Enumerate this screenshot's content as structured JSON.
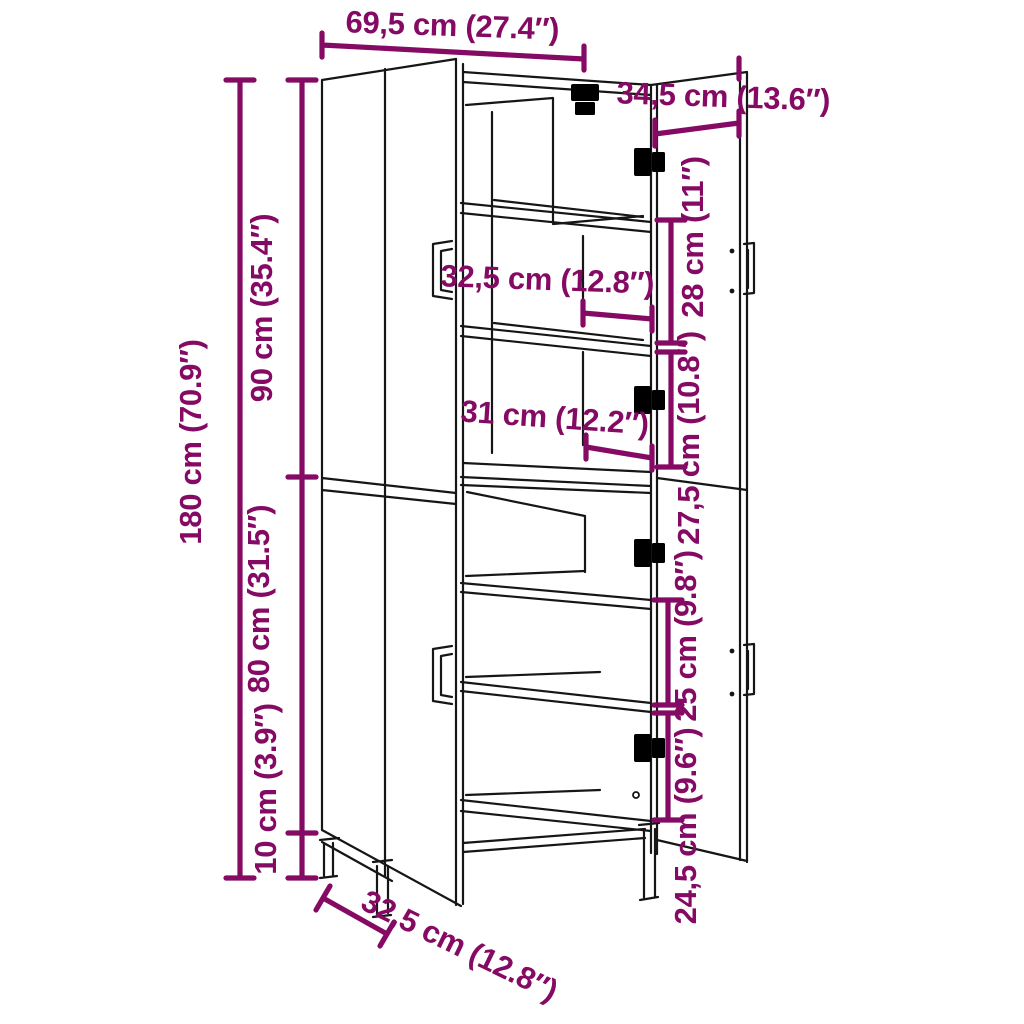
{
  "diagram": {
    "name": "tall-cabinet-dimension-diagram",
    "colors": {
      "accent": "#850a64",
      "line": "#161616",
      "background": "#ffffff"
    },
    "labels": {
      "overall_width": {
        "text": "69,5 cm (27.4″)"
      },
      "door_width": {
        "text": "34,5 cm (13.6″)"
      },
      "overall_height": {
        "text": "180 cm (70.9″)"
      },
      "upper_height": {
        "text": "90 cm (35.4″)"
      },
      "lower_height": {
        "text": "80 cm (31.5″)"
      },
      "leg_height": {
        "text": "10 cm (3.9″)"
      },
      "upper_shelf_depth": {
        "text": "32,5 cm (12.8″)"
      },
      "lower_shelf_depth": {
        "text": "31 cm (12.2″)"
      },
      "gap_upper": {
        "text": "28 cm (11″)"
      },
      "gap_mid": {
        "text": "27,5 cm (10.8″)"
      },
      "gap_lower": {
        "text": "25 cm (9.8″)"
      },
      "gap_bottom": {
        "text": "24,5 cm (9.6″)"
      },
      "overall_depth": {
        "text": "32,5 cm (12.8″)"
      }
    }
  }
}
